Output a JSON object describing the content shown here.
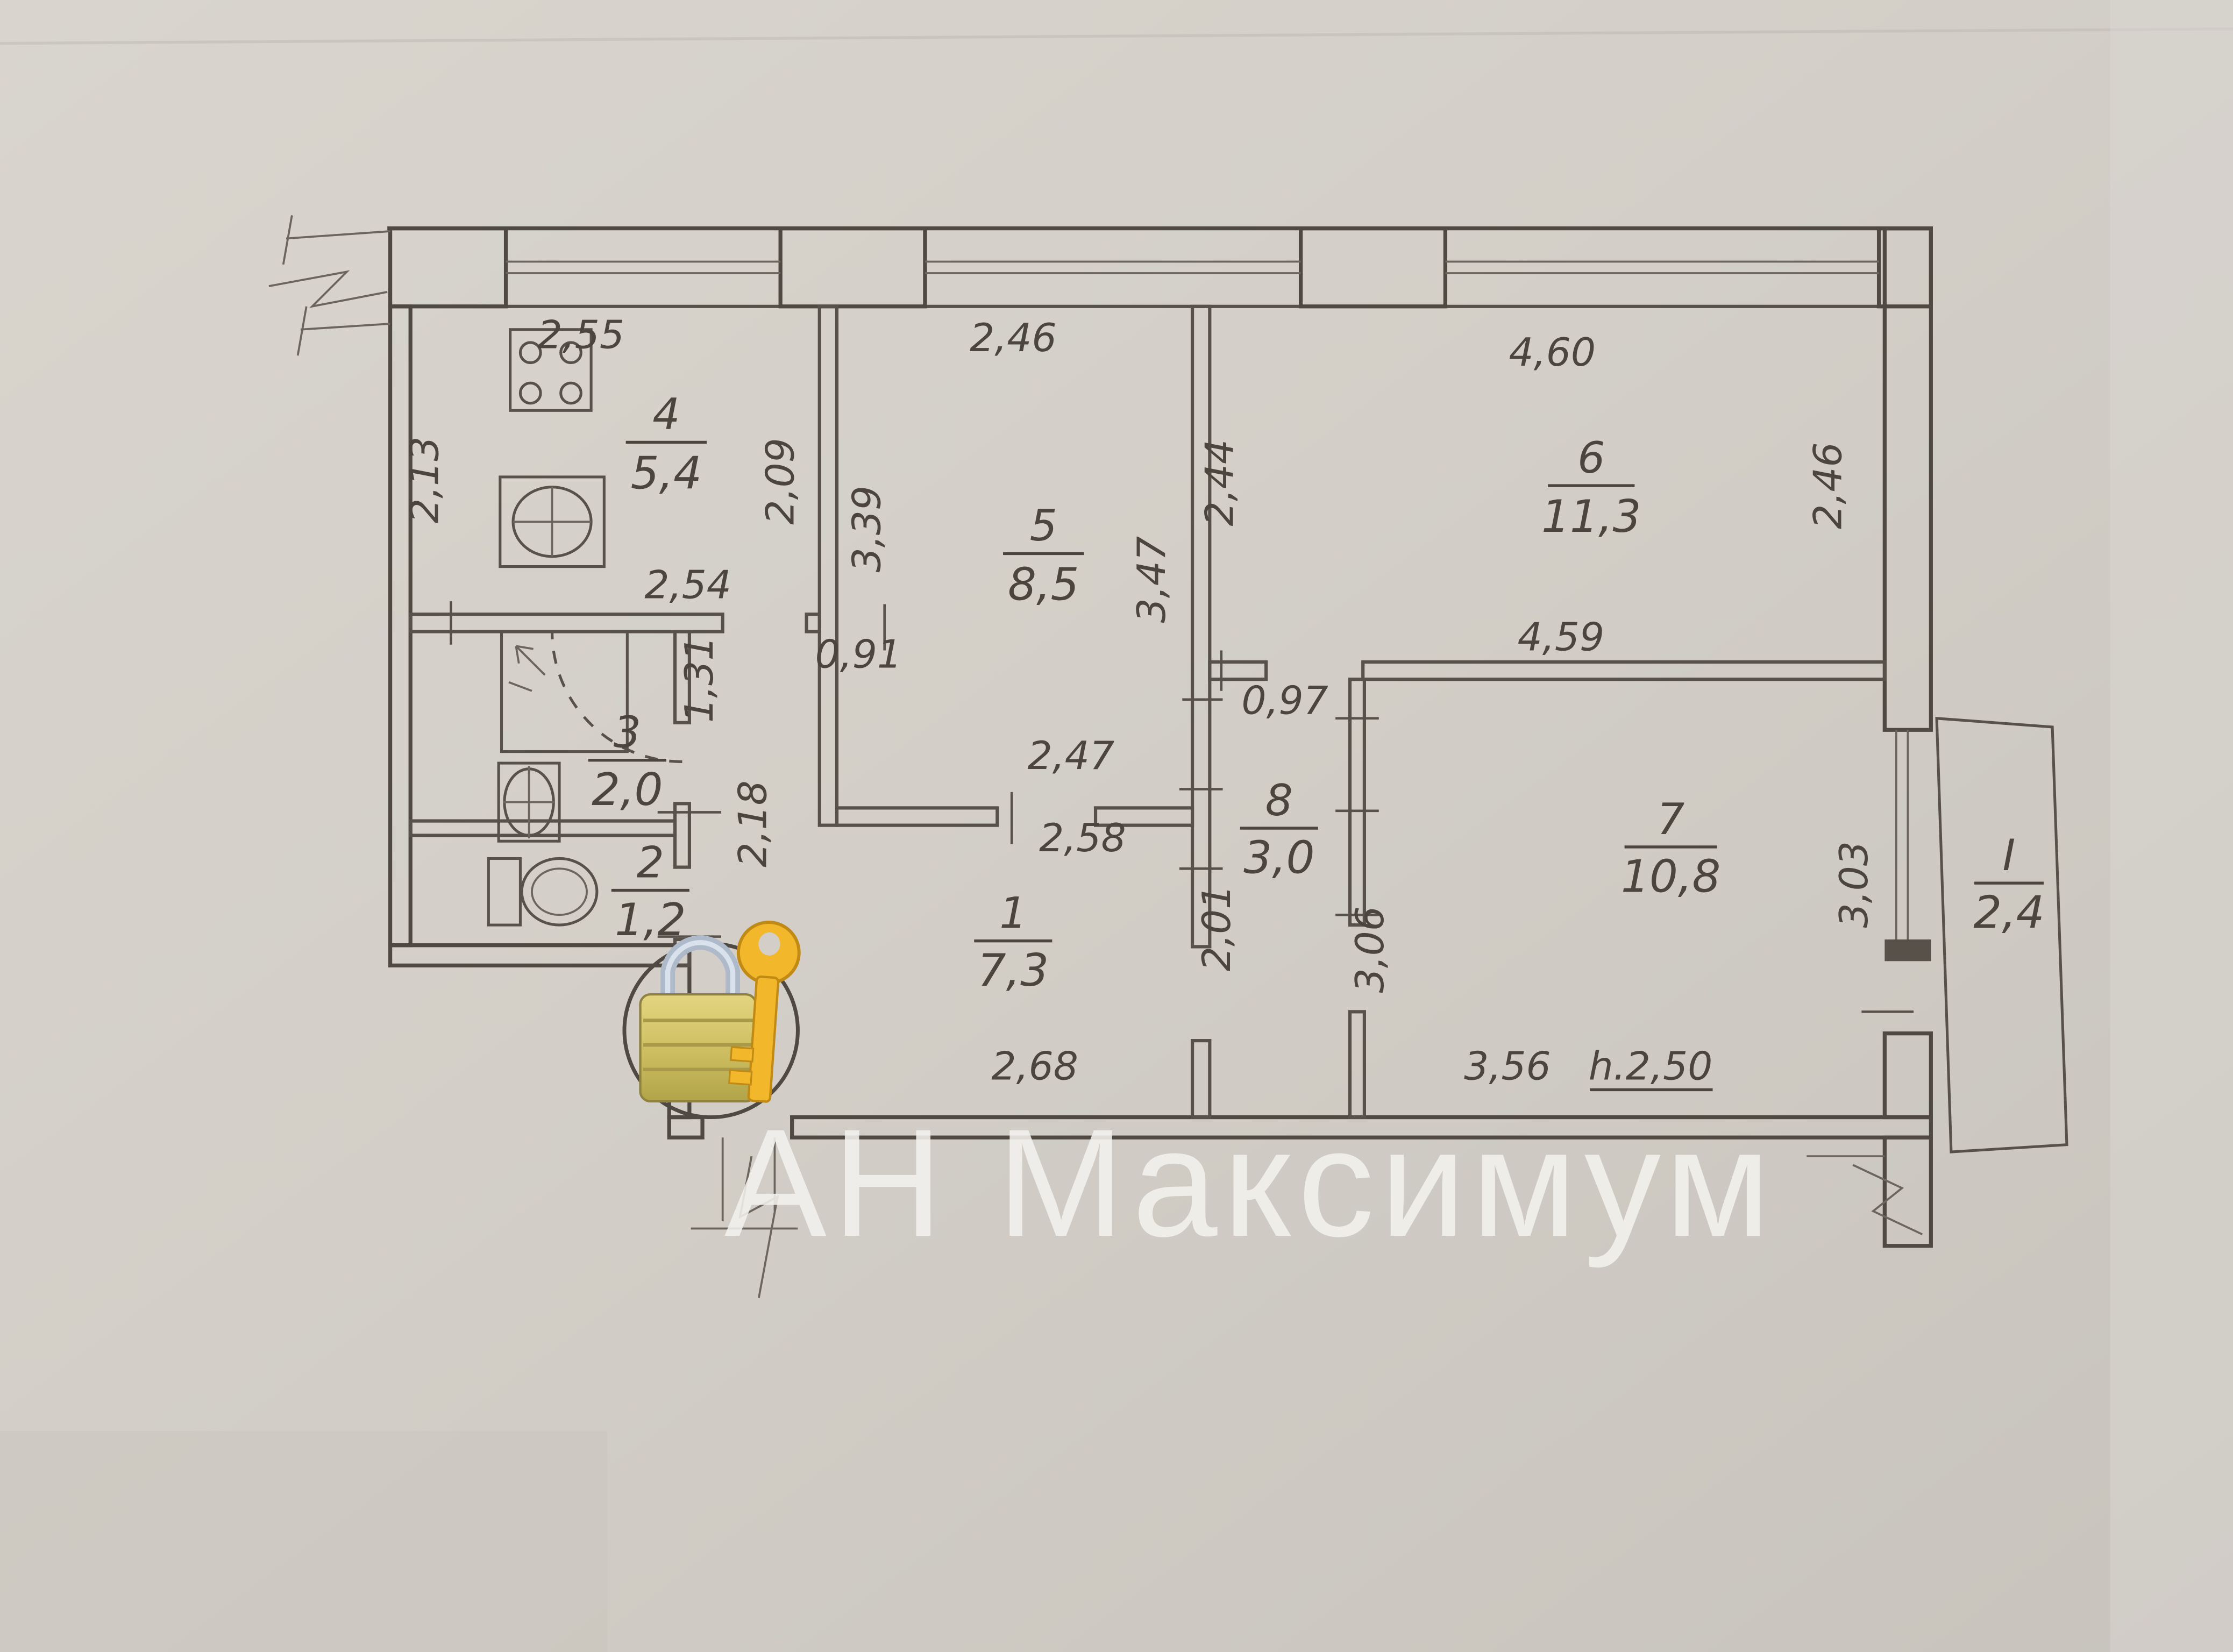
{
  "colors": {
    "paper": "#d2cec7",
    "ink": "#57514a",
    "watermark_white": "#f4f2ee",
    "lock_gold": "#d6c76a",
    "key_yellow": "#f3b72c",
    "shackle_silver": "#aeb9c9"
  },
  "icons": {
    "lock": "lock-with-key-icon",
    "stove": "stove-burners-icon",
    "kitchen_sink": "sink-cross-icon",
    "bath_sink": "sink-cross-icon",
    "toilet": "toilet-icon",
    "shower": "shower-drain-arrow-icon",
    "door_swing": "door-swing-arc-icon",
    "wall_break": "wall-break-symbol-icon"
  },
  "floor_plan": {
    "watermark": "АН Максимум",
    "rooms": {
      "kitchen": {
        "number": "4",
        "area": "5,4"
      },
      "room5": {
        "number": "5",
        "area": "8,5"
      },
      "room6": {
        "number": "6",
        "area": "11,3"
      },
      "bathroom": {
        "number": "3",
        "area": "2,0"
      },
      "toilet": {
        "number": "2",
        "area": "1,2"
      },
      "hall": {
        "number": "1",
        "area": "7,3"
      },
      "room8": {
        "number": "8",
        "area": "3,0"
      },
      "room7": {
        "number": "7",
        "area": "10,8"
      },
      "balcony": {
        "number": "I",
        "area": "2,4"
      }
    },
    "dimensions": {
      "kitchen_top": "2,55",
      "kitchen_left": "2,13",
      "kitchen_bottom": "2,54",
      "kitchen_right": "2,09",
      "room5_top": "2,46",
      "room5_left": "3,39",
      "room5_right": "3,47",
      "room6_left": "2,44",
      "room6_top": "4,60",
      "room6_right": "2,46",
      "room6_bottom": "4,59",
      "corridor_width": "0,91",
      "bathroom_right": "1,31",
      "hall_upper_left": "2,18",
      "hall_top_upper": "2,47",
      "hall_top_lower": "2,58",
      "hall_bottom": "2,68",
      "hall_right": "2,01",
      "room8_top": "0,97",
      "room8_right": "3,06",
      "balcony_wall": "3,03",
      "room7_bottom": "3,56",
      "ceiling_height": "h.2,50"
    }
  }
}
